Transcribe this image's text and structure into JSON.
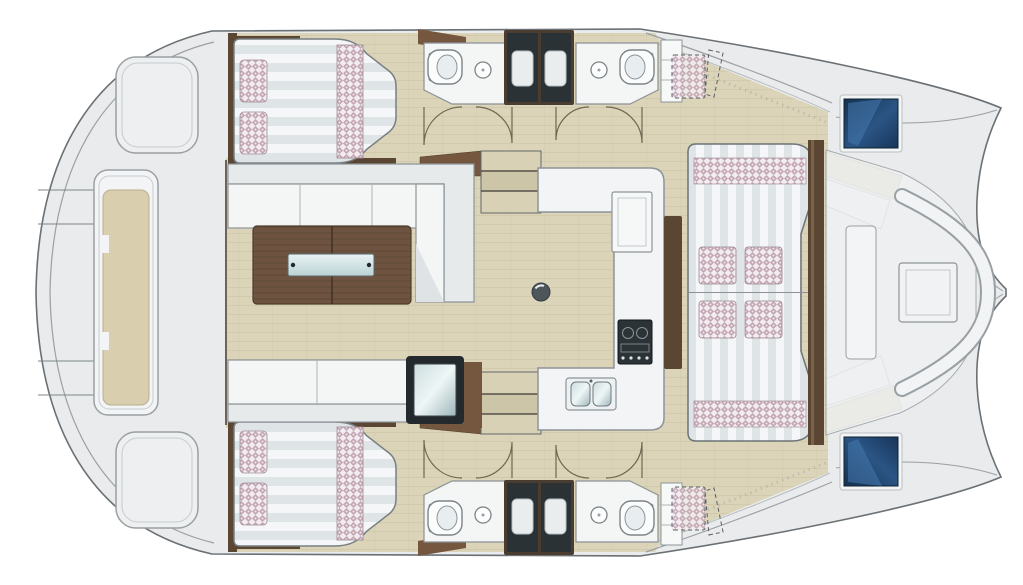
{
  "document": {
    "title": "Catamaran yacht interior floor plan, top view, bow to the right",
    "type": "boat deck layout illustration",
    "visible_text": ""
  },
  "plan": {
    "orientation": {
      "bow": "right",
      "stern": "left"
    },
    "areas": [
      {
        "id": "aft-platform",
        "label": "Aft deck platform with central bench"
      },
      {
        "id": "port-aft-cabin",
        "label": "Port aft cabin, double berth with 2 pillows"
      },
      {
        "id": "starboard-aft-cabin",
        "label": "Starboard aft cabin, double berth with 2 pillows"
      },
      {
        "id": "port-bathroom",
        "label": "Port bathroom: toilet, washbasin, shower stall"
      },
      {
        "id": "starboard-bathroom",
        "label": "Starboard bathroom: toilet, washbasin, shower stall"
      },
      {
        "id": "saloon",
        "label": "Saloon with two facing sofas and folding cocktail table"
      },
      {
        "id": "galley",
        "label": "U-shaped galley: double sink, stove, cool box"
      },
      {
        "id": "companionways",
        "label": "Two companionway stairs down to the hulls"
      },
      {
        "id": "forward-daybed",
        "label": "Forward saloon daybed with 4 cushions"
      },
      {
        "id": "forward-cockpit",
        "label": "Forward cockpit seating with table"
      },
      {
        "id": "bow-hatches",
        "label": "Two blue deck hatches over the bows"
      },
      {
        "id": "optional-berths",
        "label": "Optional forepeak berths shown dashed"
      }
    ],
    "counts": {
      "cabins": 2,
      "bathrooms": 2,
      "showers": 2,
      "daybed_pillows": 4,
      "cabin_pillows_each": 2
    }
  },
  "colors": {
    "deck": "#e9ebec",
    "deckLine": "#9aa0a4",
    "outline": "#6a7074",
    "floor": "#dbd4b8",
    "floorLine": "#c9c1a4",
    "white": "#f4f6f6",
    "counter": "#f2f4f5",
    "counterLine": "#8d9499",
    "brownDark": "#5a4633",
    "brownMid": "#74573e",
    "wood": "#6e5440",
    "mat": "#f4f6f7",
    "mat2": "#dfe4e7",
    "check": "#c3a5b2",
    "checkBase": "#f1ecef",
    "showerDark": "#2b3236",
    "tray": "#e9eded",
    "blueHatch": "#1d3d63",
    "beigeBack": "#d7cdae",
    "stove": "#2c3337",
    "doorLine": "#6e6752"
  }
}
